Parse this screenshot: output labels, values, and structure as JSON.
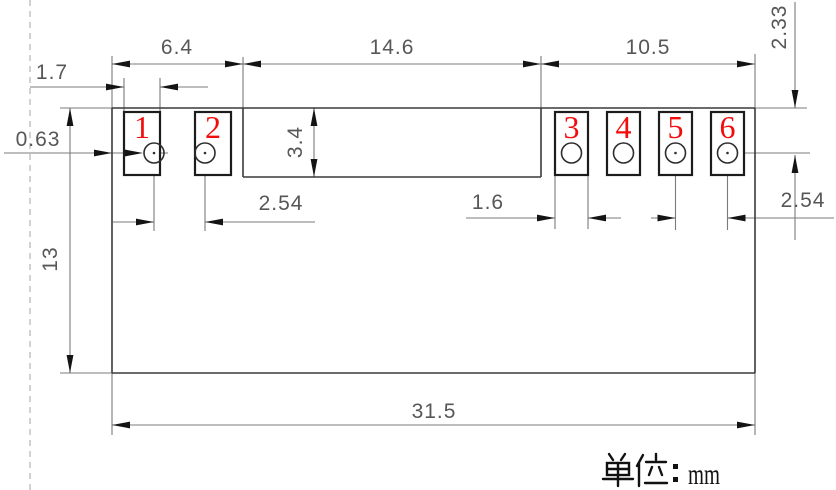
{
  "colors": {
    "pin_number_red": "#f20d0d",
    "drawing_line": "#3a3a3a",
    "pad_line": "#1c1c1c",
    "dimension_line": "#7b7b7b",
    "dimension_text": "#575757",
    "dashed_guide": "#b4b4b4",
    "background": "#ffffff"
  },
  "pads": [
    {
      "number": "1"
    },
    {
      "number": "2"
    },
    {
      "number": "3"
    },
    {
      "number": "4"
    },
    {
      "number": "5"
    },
    {
      "number": "6"
    }
  ],
  "dimensions": {
    "left_group_width": "6.4",
    "middle_section_width": "14.6",
    "right_group_width": "10.5",
    "left_pad_width": "1.7",
    "left_edge_to_pad_gap": "0.63",
    "pad_row_height": "3.4",
    "hole_offset_from_top": "2.33",
    "left_hole_pitch": "2.54",
    "right_pad_width": "1.6",
    "right_hole_pitch": "2.54",
    "body_height": "13",
    "overall_width": "31.5"
  },
  "unit_label": {
    "text": "单位：mm",
    "cjk_prefix": "单位",
    "colon": "：",
    "unit": "mm"
  }
}
